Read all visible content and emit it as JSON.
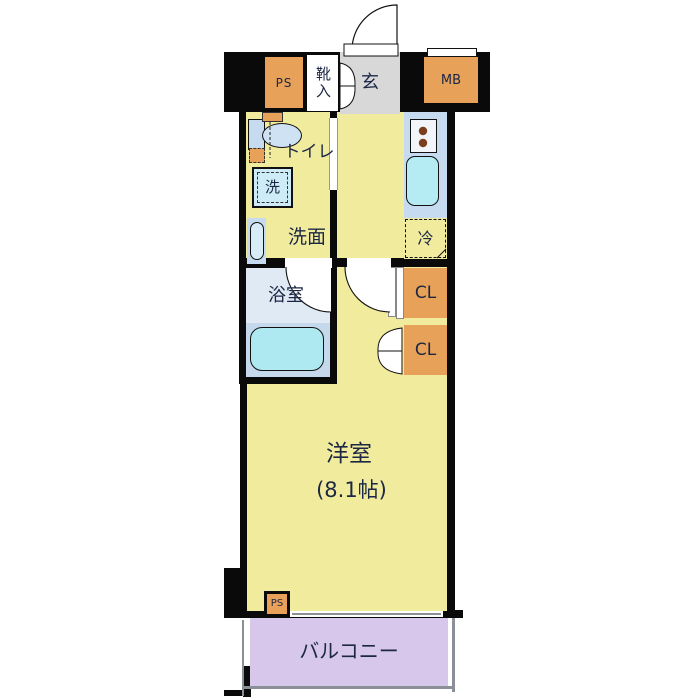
{
  "labels": {
    "ps_top": "PS",
    "shoe_cabinet": "靴入",
    "entrance": "玄",
    "meter_box": "MB",
    "toilet": "トイレ",
    "washing_machine": "洗",
    "washroom": "洗面",
    "refrigerator": "冷",
    "bathroom": "浴室",
    "closet_upper": "CL",
    "closet_lower": "CL",
    "main_room": "洋室",
    "main_room_size": "(8.1帖)",
    "ps_bottom": "PS",
    "balcony": "バルコニー"
  },
  "colors": {
    "wall": "#0a0a0a",
    "room_yellow": "#f1eb9e",
    "service_orange": "#e7a159",
    "entrance_gray": "#d8d8d8",
    "water_blue": "#c7dbf0",
    "fixture_cyan": "#aee9f2",
    "sink_cyan": "#b5ecf4",
    "bath_floor": "#dfeaf4",
    "bath_lower": "#c6d9ec",
    "balcony_lavender": "#d7c7ea",
    "text_navy": "#1c2744"
  }
}
